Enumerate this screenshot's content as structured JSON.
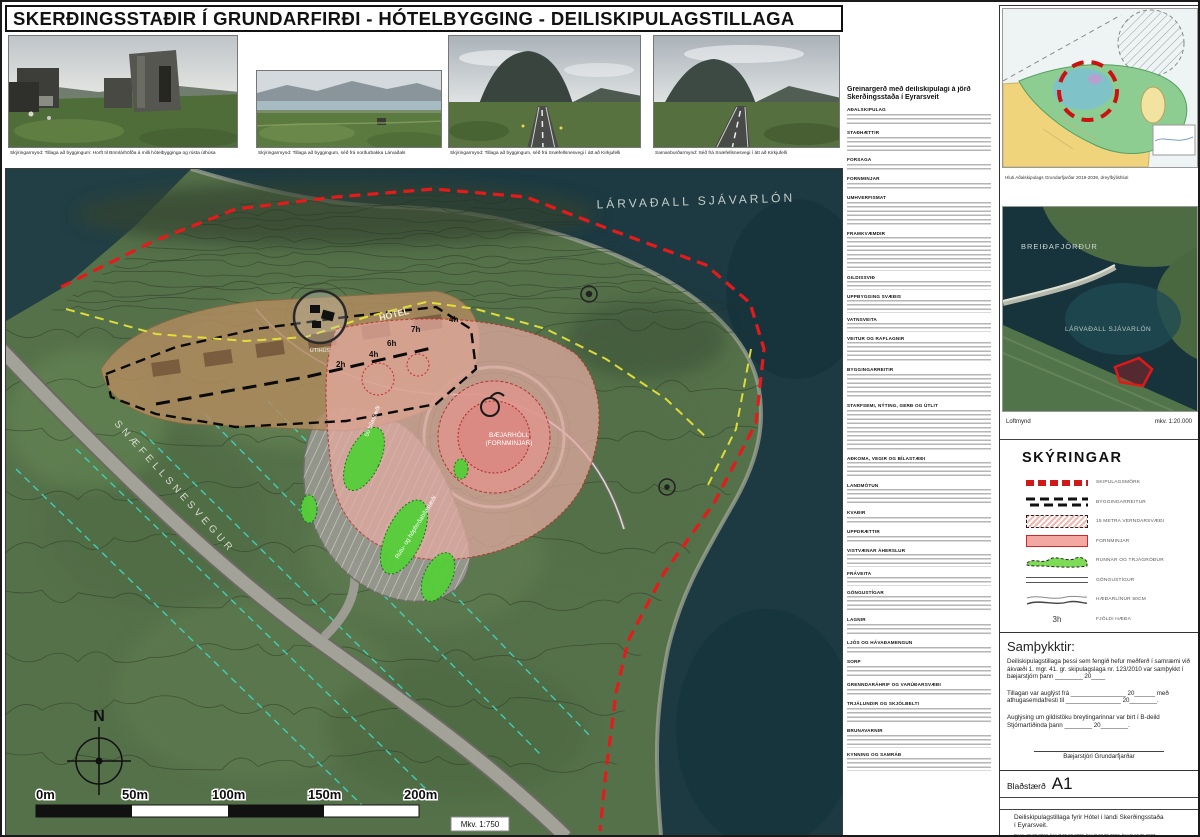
{
  "title": {
    "text": "SKERÐINGSSTAÐIR Í GRUNDARFIRÐI  -  HÓTELBYGGING  - DEILISKIPULAGSTILLAGA"
  },
  "photos": [
    {
      "caption": "Skýringarmynd: Tillaga að byggingum: Horft til Brimlárhöfða á milli hótelbygginga og rústa úthúsa"
    },
    {
      "caption": "Skýringarmynd: Tillaga að byggingum, séð frá norðurbakka Lárvaðals"
    },
    {
      "caption": "Skýringarmynd: Tillaga að byggingum, séð frá Snæfellsnesvegi í átt að Kirkjufelli"
    },
    {
      "caption": "Samanburðarmynd: Séð frá Snæfellsnesvegi í átt að Kirkjufelli"
    }
  ],
  "map": {
    "labels": {
      "lagoon": "LÁRVAÐALL SJÁVARLÓN",
      "road": "SNÆFELLSNESVEGUR",
      "hotel": "HÓTEL",
      "mound1": "BÆJARHÓLL",
      "mound2": "(FORNMINJAR)",
      "outbuildings": "ÚTIHÚS",
      "parking": "50 bílastæði",
      "bus": "Rútu- og hópferðabílastæði",
      "north": "N",
      "scale": "Mkv. 1:750"
    },
    "floors": [
      {
        "t": "7h"
      },
      {
        "t": "4h"
      },
      {
        "t": "6h"
      },
      {
        "t": "4h"
      },
      {
        "t": "2h"
      }
    ],
    "scalebar": [
      "0m",
      "50m",
      "100m",
      "150m",
      "200m"
    ]
  },
  "report": {
    "title1": "Greinargerð með deiliskipulagi á jörð",
    "title2": "Skerðingsstaða í Eyrarsveit",
    "sections": [
      {
        "h": "AÐALSKIPULAG",
        "n": 3
      },
      {
        "h": "STAÐHÆTTIR",
        "n": 4
      },
      {
        "h": "FORSAGA",
        "n": 2
      },
      {
        "h": "FORNMINJAR",
        "n": 2
      },
      {
        "h": "UMHVERFISMAT",
        "n": 6
      },
      {
        "h": "FRAMKVÆMDIR",
        "n": 8
      },
      {
        "h": "GILDISSVIÐ",
        "n": 2
      },
      {
        "h": "UPPBYGGING SVÆÐIS",
        "n": 3
      },
      {
        "h": "VATNSVEITA",
        "n": 2
      },
      {
        "h": "VEITUR OG RAFLAGNIR",
        "n": 5
      },
      {
        "h": "BYGGINGARREITIR",
        "n": 6
      },
      {
        "h": "STARFSEMI, NÝTING, GERÐ OG ÚTLIT",
        "n": 10
      },
      {
        "h": "AÐKOMA, VEGIR OG BÍLASTÆÐI",
        "n": 4
      },
      {
        "h": "LANDMÓTUN",
        "n": 4
      },
      {
        "h": "KVAÐIR",
        "n": 2
      },
      {
        "h": "UPPDRÆTTIR",
        "n": 2
      },
      {
        "h": "VISTVÆNAR ÁHERSLUR",
        "n": 3
      },
      {
        "h": "FRÁVEITA",
        "n": 2
      },
      {
        "h": "GÖNGUSTÍGAR",
        "n": 4
      },
      {
        "h": "LAGNIR",
        "n": 3
      },
      {
        "h": "LJÓS OG HÁVAÐAMENGUN",
        "n": 2
      },
      {
        "h": "SORP",
        "n": 3
      },
      {
        "h": "GRENNDARÁHRIF OG VARÚÐARSVÆÐI",
        "n": 2
      },
      {
        "h": "TRJÁLUNDIR OG SKJÓLBELTI",
        "n": 4
      },
      {
        "h": "BRUNAVARNIR",
        "n": 3
      },
      {
        "h": "KYNNING OG SAMRÁÐ",
        "n": 3
      }
    ]
  },
  "sidebar": {
    "plan_caption": "Hluti Aðalskipulags Grundarfjarðar 2019-2039,  dreyfbýlishluti",
    "aerial": {
      "sea": "BREIÐAFJÖRÐUR",
      "lagoon": "LÁRVAÐALL SJÁVARLÓN",
      "caption": "Loftmynd",
      "scale": "mkv. 1:20.000"
    },
    "legend": {
      "title": "SKÝRINGAR",
      "items": [
        {
          "label": "SKIPULAGSMÖRK"
        },
        {
          "label": "BYGGINGARREITUR"
        },
        {
          "label": "15 METRA VERNDARSVÆÐI"
        },
        {
          "label": "FORNMINJAR"
        },
        {
          "label": "RUNNAR OG TRJÁGRÓÐUR"
        },
        {
          "label": "GÖNGUSTÍGUR"
        },
        {
          "label": "HÆÐARLÍNUR 50CM"
        },
        {
          "label": "FJÖLDI HÆÐA",
          "symbol": "3h"
        }
      ]
    },
    "approvals": {
      "title": "Samþykktir:",
      "p1": "Deiliskipulagstillaga þessi sem fengið hefur meðferð í samræmi við ákvæði 1. mgr. 41. gr. skipulagslaga nr. 123/2010 var samþykkt í bæjarstjórn þann ________ 20____",
      "p2": "Tillagan var auglýst frá ________________ 20______  með athugasemdafresti til ________________ 20________.",
      "p3": "Auglýsing um gildistöku breytingarinnar var birt í B-deild Stjórnartíðinda þann ________ 20________.",
      "sign": "Bæjarstjóri Grundarfjarðar"
    },
    "sheet": {
      "label": "Blaðstærð",
      "size": "A1"
    },
    "project": {
      "title": "Deiliskipulagstillaga fyrir Hótel í landi Skerðingsstaða í Eyrarsveit.",
      "dates": "Dags. 26.02.2018,  breytt 06.02.2020,  breytt 03.05.2022,  breytt 17.05.2023"
    },
    "logo": {
      "z": "Z",
      "rest": "EPPELIN",
      "line2": "ARKITEKTAR"
    }
  },
  "colors": {
    "boundary_red": "#e51b1b",
    "yellow_dash": "#e6e23a",
    "cyan_dash": "#3fd9c2",
    "shrub_green": "#55cf38",
    "fornminjar_pink": "#e7aba3",
    "hotel_tan": "#b38c60",
    "water": "#1d3a42",
    "land": "#55714a"
  }
}
